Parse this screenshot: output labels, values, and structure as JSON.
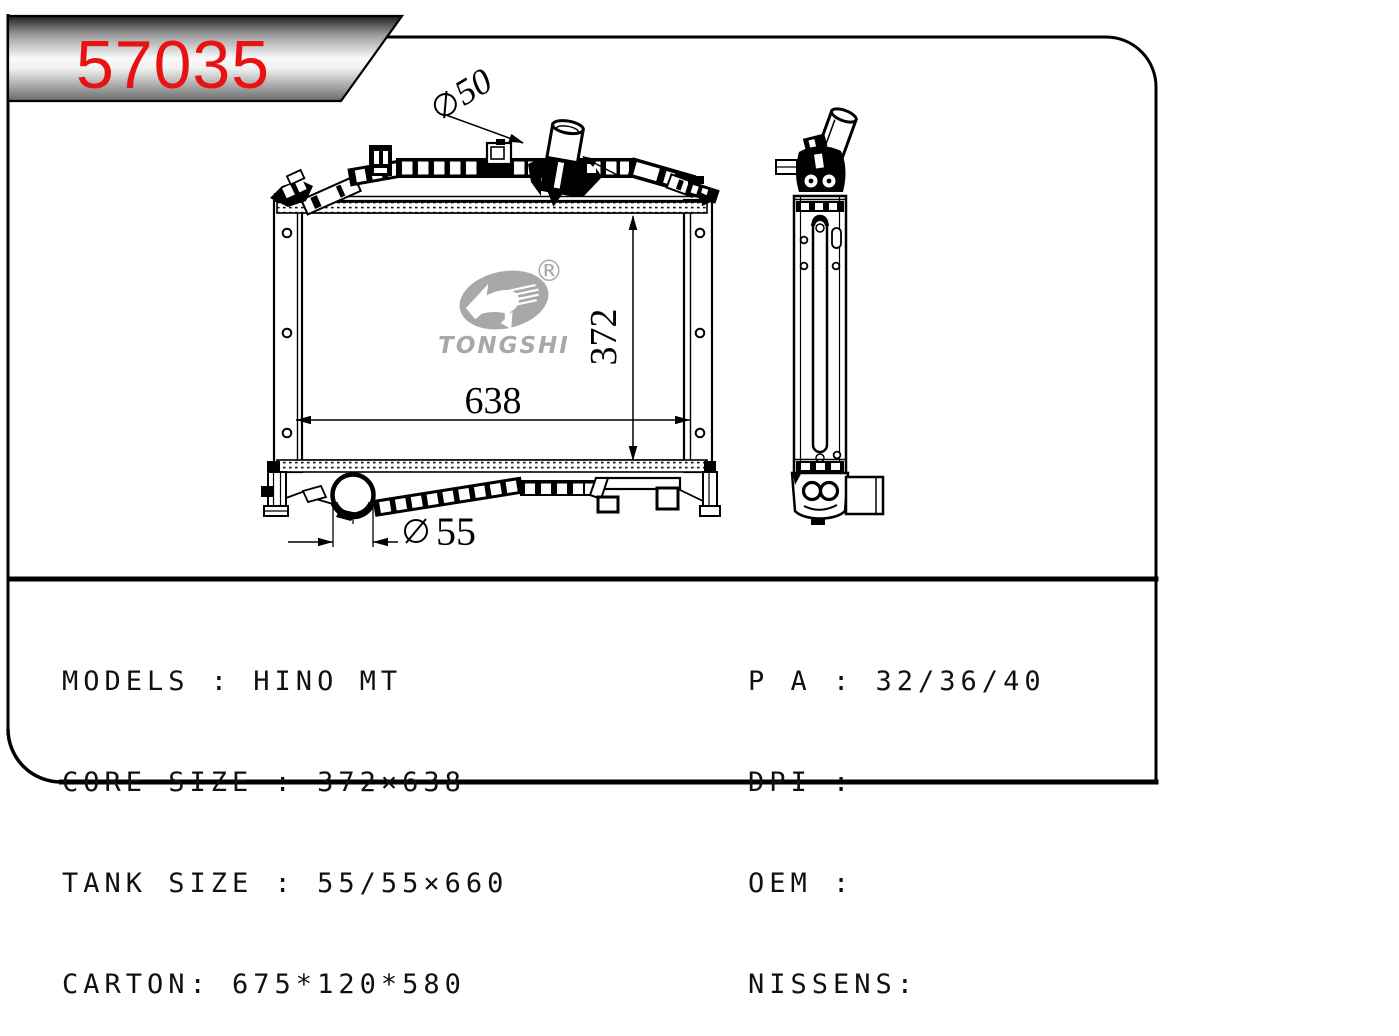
{
  "badge": {
    "part_number": "57035"
  },
  "logo": {
    "brand": "TONGSHI",
    "registered_mark": "®"
  },
  "dimensions": {
    "inlet": {
      "symbol": "∅",
      "value": "50"
    },
    "core_height": "372",
    "core_width": "638",
    "drain": {
      "symbol": "∅",
      "value": "55"
    }
  },
  "specs": {
    "left": [
      "MODELS : HINO MT",
      "CORE SIZE : 372×638",
      "TANK SIZE : 55/55×660",
      "CARTON: 675*120*580"
    ],
    "right": [
      "P A : 32/36/40",
      "DPI :",
      "OEM :",
      "NISSENS:"
    ]
  },
  "colors": {
    "part_number_red": "#e81212",
    "logo_gray": "#a8a8a8",
    "line_black": "#000000"
  }
}
